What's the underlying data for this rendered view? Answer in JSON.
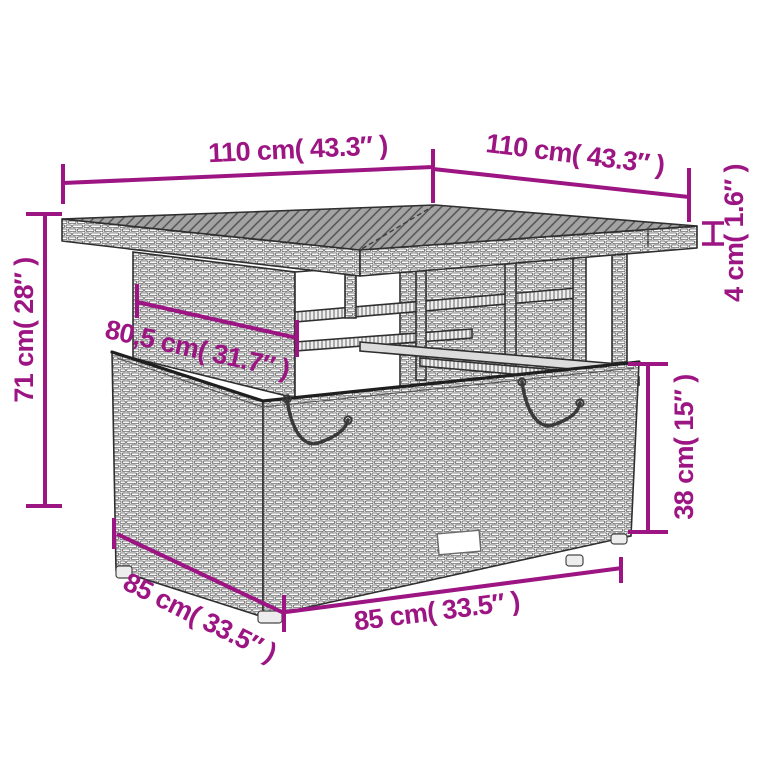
{
  "diagram": {
    "type": "product-dimension-diagram",
    "subject": "poly-rattan garden table with storage base",
    "background_color": "#ffffff",
    "accent_color": "#9C1583",
    "line_art_color": "#2f2f2f",
    "dimensions": {
      "top_width": "110 cm( 43.3″ )",
      "top_depth": "110 cm( 43.3″ )",
      "top_thickness": "4 cm( 1.6″ )",
      "total_height": "71 cm( 28″ )",
      "apron_width": "80,5 cm( 31.7″ )",
      "base_height": "38 cm( 15″ )",
      "base_depth": "85 cm( 33.5″ )",
      "base_width": "85 cm( 33.5″ )"
    }
  }
}
